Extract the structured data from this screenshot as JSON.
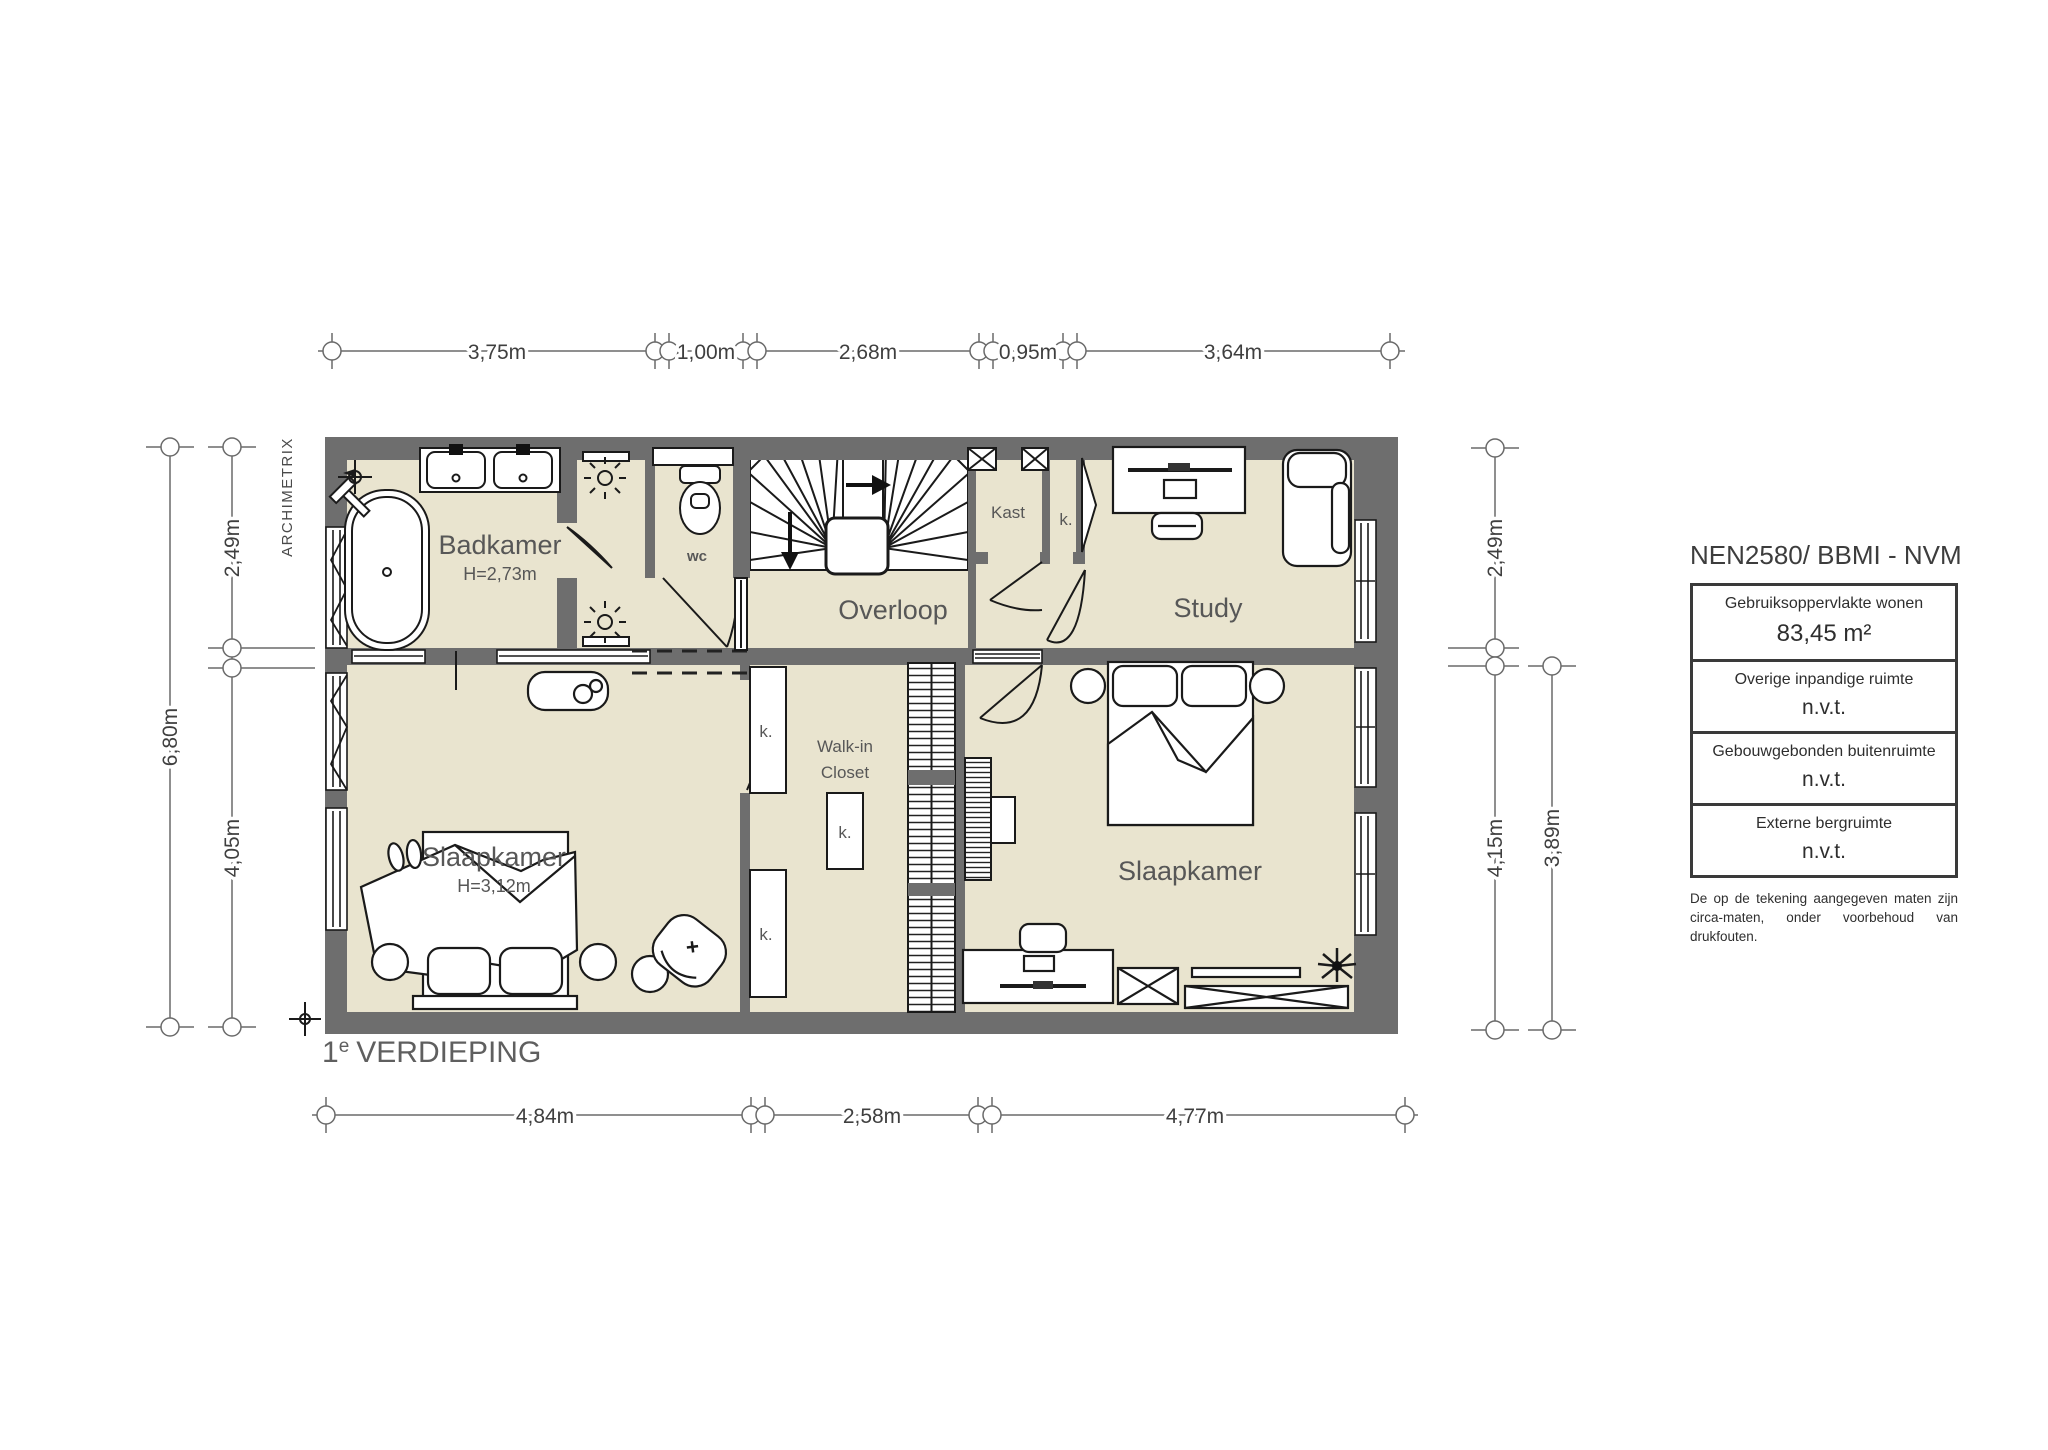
{
  "branding": {
    "name": "ARCHIMETRIX"
  },
  "floor_label": {
    "prefix": "1",
    "sup": "e",
    "text": "VERDIEPING"
  },
  "rooms": {
    "badkamer": {
      "name": "Badkamer",
      "height": "H=2,73m"
    },
    "wc": {
      "name": "wc"
    },
    "overloop": {
      "name": "Overloop"
    },
    "kast": {
      "name": "Kast"
    },
    "k_small": {
      "name": "k."
    },
    "study": {
      "name": "Study"
    },
    "walk_in_closet": {
      "line1": "Walk-in",
      "line2": "Closet"
    },
    "slaapkamer_left": {
      "name": "Slaapkamer",
      "height": "H=3,12m"
    },
    "slaapkamer_right": {
      "name": "Slaapkamer"
    }
  },
  "dimensions": {
    "top": [
      "3,75m",
      "1,00m",
      "2,68m",
      "0,95m",
      "3,64m"
    ],
    "bottom": [
      "4,84m",
      "2,58m",
      "4,77m"
    ],
    "left": {
      "total": "6,80m",
      "upper": "2,49m",
      "lower": "4,05m"
    },
    "right": {
      "upper": "2,49m",
      "inner_lower": "4,15m",
      "outer_lower": "3,89m"
    }
  },
  "legend": {
    "title": "NEN2580/ BBMI - NVM",
    "rows": [
      {
        "label": "Gebruiksoppervlakte wonen",
        "value": "83,45 m²"
      },
      {
        "label": "Overige inpandige ruimte",
        "value": "n.v.t."
      },
      {
        "label": "Gebouwgebonden buitenruimte",
        "value": "n.v.t."
      },
      {
        "label": "Externe bergruimte",
        "value": "n.v.t."
      }
    ],
    "disclaimer": [
      "De op de tekening aangegeven maten zijn",
      "circa-maten, onder voorbehoud van drukfouten."
    ]
  },
  "colors": {
    "floor": "#e9e4cf",
    "wall": "#6e6e6e",
    "line": "#1a1a1a",
    "label": "#575757"
  }
}
